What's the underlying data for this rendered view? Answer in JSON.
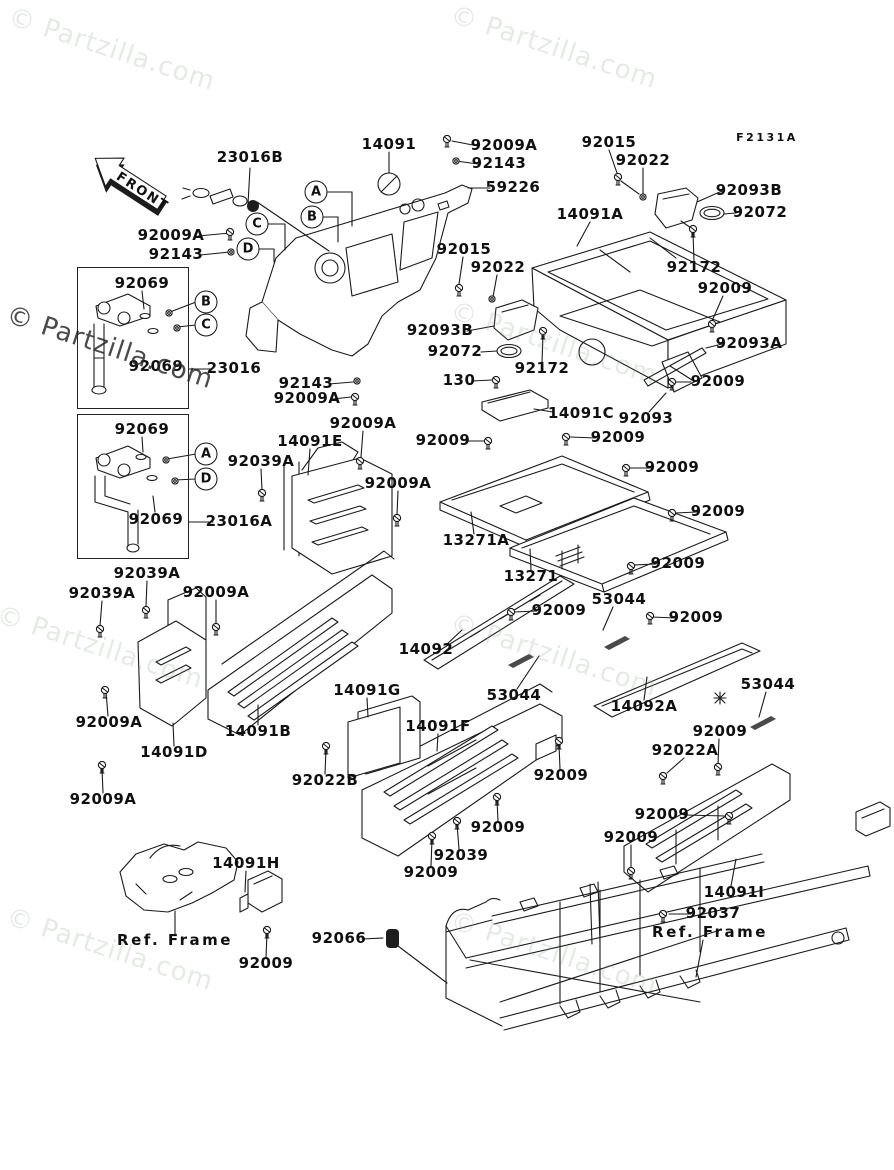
{
  "page": {
    "width": 894,
    "height": 1170,
    "background": "#ffffff"
  },
  "front": {
    "label": "FRONT"
  },
  "watermark": {
    "text": "© Partzilla.com",
    "light_color": "#8aa08a",
    "dark_color": "#2a2a2a"
  },
  "watermarks": [
    {
      "x": 14,
      "y": 2,
      "v": "light"
    },
    {
      "x": 456,
      "y": 0,
      "v": "light"
    },
    {
      "x": 12,
      "y": 300,
      "v": "dark"
    },
    {
      "x": 456,
      "y": 296,
      "v": "light"
    },
    {
      "x": 2,
      "y": 600,
      "v": "light"
    },
    {
      "x": 456,
      "y": 608,
      "v": "light"
    },
    {
      "x": 12,
      "y": 902,
      "v": "light"
    },
    {
      "x": 456,
      "y": 906,
      "v": "light"
    }
  ],
  "labels": [
    {
      "text": "F2131A",
      "x": 767,
      "y": 138,
      "cls": "code"
    },
    {
      "text": "23016B",
      "x": 250,
      "y": 158
    },
    {
      "text": "14091",
      "x": 389,
      "y": 145
    },
    {
      "text": "92009A",
      "x": 504,
      "y": 146
    },
    {
      "text": "92143",
      "x": 499,
      "y": 164
    },
    {
      "text": "59226",
      "x": 513,
      "y": 188
    },
    {
      "text": "92015",
      "x": 609,
      "y": 143
    },
    {
      "text": "92022",
      "x": 643,
      "y": 161
    },
    {
      "text": "92093B",
      "x": 749,
      "y": 191
    },
    {
      "text": "92072",
      "x": 760,
      "y": 213
    },
    {
      "text": "14091A",
      "x": 590,
      "y": 215
    },
    {
      "text": "92009A",
      "x": 171,
      "y": 236
    },
    {
      "text": "92143",
      "x": 176,
      "y": 255
    },
    {
      "text": "92015",
      "x": 464,
      "y": 250
    },
    {
      "text": "92022",
      "x": 498,
      "y": 268
    },
    {
      "text": "92172",
      "x": 694,
      "y": 268
    },
    {
      "text": "92009",
      "x": 725,
      "y": 289
    },
    {
      "text": "92093B",
      "x": 440,
      "y": 331
    },
    {
      "text": "92072",
      "x": 455,
      "y": 352
    },
    {
      "text": "92093A",
      "x": 749,
      "y": 344
    },
    {
      "text": "92172",
      "x": 542,
      "y": 369
    },
    {
      "text": "130",
      "x": 459,
      "y": 381
    },
    {
      "text": "92009",
      "x": 718,
      "y": 382
    },
    {
      "text": "14091C",
      "x": 581,
      "y": 414
    },
    {
      "text": "92093",
      "x": 646,
      "y": 419
    },
    {
      "text": "92143",
      "x": 306,
      "y": 384
    },
    {
      "text": "92009A",
      "x": 307,
      "y": 399
    },
    {
      "text": "92069",
      "x": 142,
      "y": 284
    },
    {
      "text": "92069",
      "x": 156,
      "y": 367
    },
    {
      "text": "23016",
      "x": 234,
      "y": 369
    },
    {
      "text": "92069",
      "x": 142,
      "y": 430
    },
    {
      "text": "92069",
      "x": 156,
      "y": 520
    },
    {
      "text": "23016A",
      "x": 239,
      "y": 522
    },
    {
      "text": "92009A",
      "x": 363,
      "y": 424
    },
    {
      "text": "14091E",
      "x": 310,
      "y": 442
    },
    {
      "text": "92039A",
      "x": 261,
      "y": 462
    },
    {
      "text": "92009A",
      "x": 398,
      "y": 484
    },
    {
      "text": "92009",
      "x": 443,
      "y": 441
    },
    {
      "text": "92009",
      "x": 618,
      "y": 438
    },
    {
      "text": "92009",
      "x": 672,
      "y": 468
    },
    {
      "text": "92009",
      "x": 718,
      "y": 512
    },
    {
      "text": "13271A",
      "x": 476,
      "y": 541
    },
    {
      "text": "13271",
      "x": 531,
      "y": 577
    },
    {
      "text": "92009",
      "x": 678,
      "y": 564
    },
    {
      "text": "92039A",
      "x": 147,
      "y": 574
    },
    {
      "text": "92039A",
      "x": 102,
      "y": 594
    },
    {
      "text": "92009A",
      "x": 216,
      "y": 593
    },
    {
      "text": "14092",
      "x": 426,
      "y": 650
    },
    {
      "text": "92009A",
      "x": 109,
      "y": 723
    },
    {
      "text": "14091D",
      "x": 174,
      "y": 753
    },
    {
      "text": "14091B",
      "x": 258,
      "y": 732
    },
    {
      "text": "92009A",
      "x": 103,
      "y": 800
    },
    {
      "text": "92009",
      "x": 559,
      "y": 611
    },
    {
      "text": "53044",
      "x": 619,
      "y": 600
    },
    {
      "text": "92009",
      "x": 696,
      "y": 618
    },
    {
      "text": "53044",
      "x": 514,
      "y": 696
    },
    {
      "text": "14092A",
      "x": 644,
      "y": 707
    },
    {
      "text": "53044",
      "x": 768,
      "y": 685
    },
    {
      "text": "92009",
      "x": 720,
      "y": 732
    },
    {
      "text": "92022A",
      "x": 685,
      "y": 751
    },
    {
      "text": "92009",
      "x": 662,
      "y": 815
    },
    {
      "text": "92009",
      "x": 631,
      "y": 838
    },
    {
      "text": "14091I",
      "x": 734,
      "y": 893
    },
    {
      "text": "92037",
      "x": 713,
      "y": 914
    },
    {
      "text": "Ref. Frame",
      "x": 710,
      "y": 933,
      "cls": "spaced"
    },
    {
      "text": "14091G",
      "x": 367,
      "y": 691
    },
    {
      "text": "14091F",
      "x": 438,
      "y": 727
    },
    {
      "text": "92022B",
      "x": 325,
      "y": 781
    },
    {
      "text": "92009",
      "x": 561,
      "y": 776
    },
    {
      "text": "92009",
      "x": 498,
      "y": 828
    },
    {
      "text": "92039",
      "x": 461,
      "y": 856
    },
    {
      "text": "92009",
      "x": 431,
      "y": 873
    },
    {
      "text": "14091H",
      "x": 246,
      "y": 864
    },
    {
      "text": "Ref. Frame",
      "x": 175,
      "y": 941,
      "cls": "spaced"
    },
    {
      "text": "92009",
      "x": 266,
      "y": 964
    },
    {
      "text": "92066",
      "x": 339,
      "y": 939
    }
  ],
  "callouts": [
    {
      "letter": "A",
      "x": 316,
      "y": 192
    },
    {
      "letter": "B",
      "x": 312,
      "y": 217
    },
    {
      "letter": "C",
      "x": 257,
      "y": 224
    },
    {
      "letter": "D",
      "x": 248,
      "y": 249
    },
    {
      "letter": "B",
      "x": 206,
      "y": 302
    },
    {
      "letter": "C",
      "x": 206,
      "y": 325
    },
    {
      "letter": "A",
      "x": 206,
      "y": 454
    },
    {
      "letter": "D",
      "x": 206,
      "y": 479
    }
  ],
  "assembly_boxes": [
    {
      "x": 77,
      "y": 267,
      "w": 110,
      "h": 140
    },
    {
      "x": 77,
      "y": 414,
      "w": 110,
      "h": 143
    }
  ],
  "leaders": [
    "250,168 248,204",
    "389,152 389,173",
    "478,146 452,141",
    "478,164 456,161",
    "490,188 468,188",
    "609,150 617,173",
    "643,168 643,194",
    "722,191 697,202",
    "736,213 724,214",
    "590,222 577,246",
    "694,261 693,233",
    "723,296 712,321",
    "198,236 230,233",
    "200,255 230,252",
    "463,257 459,284",
    "497,275 493,297",
    "467,331 494,326",
    "481,352 497,351",
    "722,344 706,348",
    "542,362 543,334",
    "472,381 492,380",
    "691,382 674,382",
    "553,412 534,409",
    "649,412 666,393",
    "329,384 353,382",
    "333,399 351,397",
    "142,291 144,309",
    "196,302 170,312",
    "196,325 177,327",
    "212,369 189,369",
    "142,437 143,452",
    "196,454 167,459",
    "196,479 175,480",
    "155,512 153,496",
    "213,522 189,522",
    "363,431 361,457",
    "310,449 308,475",
    "261,469 262,490",
    "398,491 397,515",
    "466,441 485,441",
    "596,438 570,437",
    "651,468 629,468",
    "697,512 675,513",
    "474,534 471,512",
    "531,570 530,549",
    "656,564 634,565",
    "147,581 146,606",
    "102,601 100,626",
    "216,600 216,624",
    "446,645 462,630",
    "108,716 106,692",
    "174,746 173,723",
    "258,725 258,705",
    "103,793 102,768",
    "537,611 514,612",
    "613,607 603,630",
    "675,618 652,617",
    "517,689 539,656",
    "644,700 647,677",
    "766,692 759,717",
    "719,739 718,764",
    "684,758 667,773",
    "684,815 726,816",
    "631,845 631,868",
    "731,886 736,859",
    "691,914 669,914",
    "703,940 696,977",
    "367,698 368,717",
    "438,734 437,751",
    "325,774 326,749",
    "560,769 559,744",
    "498,821 497,800",
    "459,849 457,824",
    "431,866 432,839",
    "246,871 245,892",
    "175,934 175,911",
    "266,957 267,933",
    "362,939 383,938",
    "398,946 447,983",
    "257,202 329,251",
    "326,192 352,192 352,226",
    "322,217 338,217 338,242",
    "267,224 285,224 285,250",
    "258,249 274,249 274,262",
    "621,181 639,194",
    "681,221 691,228"
  ],
  "screws": [
    [
      447,
      139
    ],
    [
      618,
      177
    ],
    [
      230,
      232
    ],
    [
      459,
      288
    ],
    [
      693,
      229
    ],
    [
      712,
      324
    ],
    [
      543,
      331
    ],
    [
      496,
      380
    ],
    [
      672,
      382
    ],
    [
      355,
      397
    ],
    [
      360,
      461
    ],
    [
      262,
      493
    ],
    [
      397,
      518
    ],
    [
      488,
      441
    ],
    [
      566,
      437
    ],
    [
      626,
      468
    ],
    [
      672,
      513
    ],
    [
      631,
      566
    ],
    [
      146,
      610
    ],
    [
      100,
      629
    ],
    [
      216,
      627
    ],
    [
      105,
      690
    ],
    [
      102,
      765
    ],
    [
      511,
      612
    ],
    [
      650,
      616
    ],
    [
      718,
      767
    ],
    [
      663,
      776
    ],
    [
      729,
      816
    ],
    [
      631,
      871
    ],
    [
      663,
      914
    ],
    [
      559,
      741
    ],
    [
      497,
      797
    ],
    [
      457,
      821
    ],
    [
      432,
      836
    ],
    [
      326,
      746
    ],
    [
      267,
      930
    ]
  ],
  "nuts": [
    [
      456,
      161
    ],
    [
      231,
      252
    ],
    [
      643,
      197
    ],
    [
      492,
      299
    ],
    [
      169,
      313
    ],
    [
      177,
      328
    ],
    [
      166,
      460
    ],
    [
      175,
      481
    ],
    [
      357,
      381
    ]
  ],
  "washers": [
    [
      145,
      316
    ],
    [
      153,
      331
    ],
    [
      141,
      457
    ],
    [
      152,
      478
    ]
  ],
  "grommet": {
    "x": 386,
    "y": 929,
    "w": 13,
    "h": 19
  }
}
